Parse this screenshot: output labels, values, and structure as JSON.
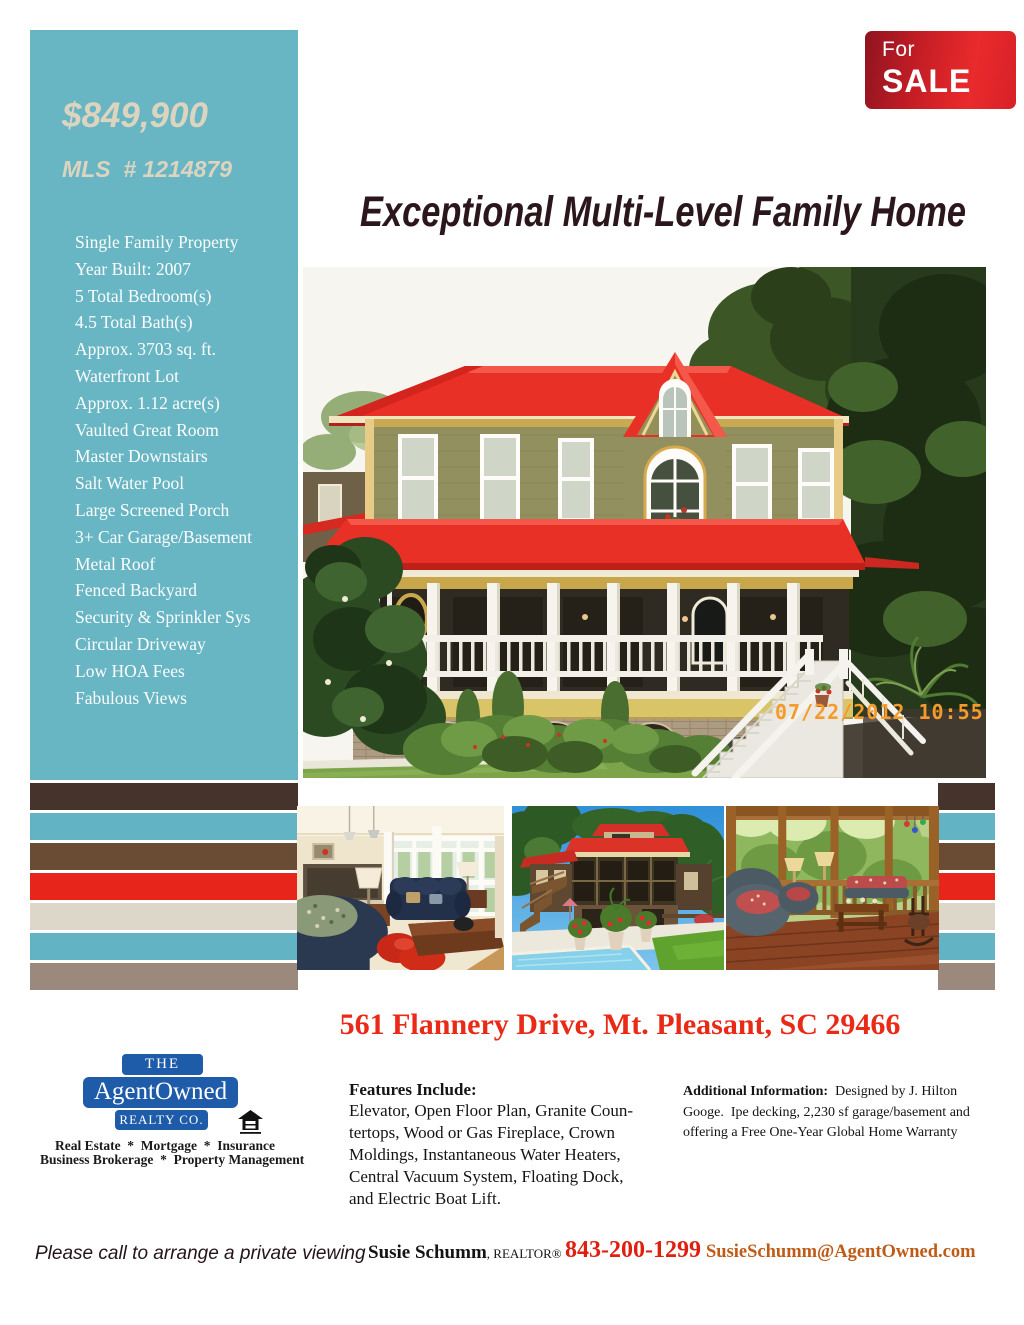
{
  "sidebar": {
    "price": "$849,900",
    "mls": "MLS  # 1214879",
    "features": [
      "Single Family Property",
      "Year Built: 2007",
      "5 Total Bedroom(s)",
      "4.5 Total Bath(s)",
      "Approx. 3703 sq. ft.",
      "Waterfront Lot",
      "Approx. 1.12 acre(s)",
      "Vaulted Great Room",
      "Master Downstairs",
      "Salt Water Pool",
      "Large Screened Porch",
      "3+ Car Garage/Basement",
      "Metal Roof",
      "Fenced Backyard",
      "Security & Sprinkler Sys",
      "Circular Driveway",
      "Low HOA Fees",
      "Fabulous Views"
    ]
  },
  "badge": {
    "top": "For",
    "bottom": "SALE"
  },
  "title": {
    "text": "Exceptional Multi-Level Family Home"
  },
  "main_photo": {
    "timestamp": "07/22/2012 10:55"
  },
  "address": {
    "text": "561 Flannery Drive, Mt. Pleasant, SC 29466"
  },
  "logo": {
    "the": "THE",
    "name": "AgentOwned",
    "realty": "REALTY CO.",
    "tagline_line1": "Real Estate  *  Mortgage  *  Insurance",
    "tagline_line2": "Business Brokerage  *  Property Management"
  },
  "features_section": {
    "heading": "Features Include:",
    "body": "Elevator, Open Floor Plan, Granite Coun-\ntertops, Wood or Gas Fireplace, Crown\nMoldings, Instantaneous Water Heaters,\nCentral Vacuum System, Floating Dock,\nand Electric Boat Lift."
  },
  "additional_section": {
    "heading": "Additional Information:",
    "body": "  Designed by J. Hilton\nGooge.  Ipe decking, 2,230 sf garage/basement and\noffering a Free One-Year Global Home Warranty"
  },
  "contact": {
    "cta": "Please call to arrange a private viewing",
    "agent": "Susie Schumm",
    "agent_suffix": ", REALTOR®",
    "phone": "843-200-1299",
    "email": "SusieSchumm@AgentOwned.com"
  },
  "stripes": {
    "colors": [
      "#46332b",
      "#62b4c4",
      "#6a4c35",
      "#e7251b",
      "#dcd7c9",
      "#62b4c4",
      "#9b897d"
    ]
  },
  "colors": {
    "sidebar_teal": "#68b6c4",
    "price_cream": "#dcd4bf",
    "badge_red_dark": "#8e1420",
    "badge_red": "#ea2a2c",
    "title_maroon": "#2b161c",
    "address_red": "#e82a17",
    "logo_blue": "#1e5ba9",
    "phone_red": "#df1f10",
    "email_orange": "#bf5b16",
    "timestamp_orange": "#f59b2b"
  }
}
